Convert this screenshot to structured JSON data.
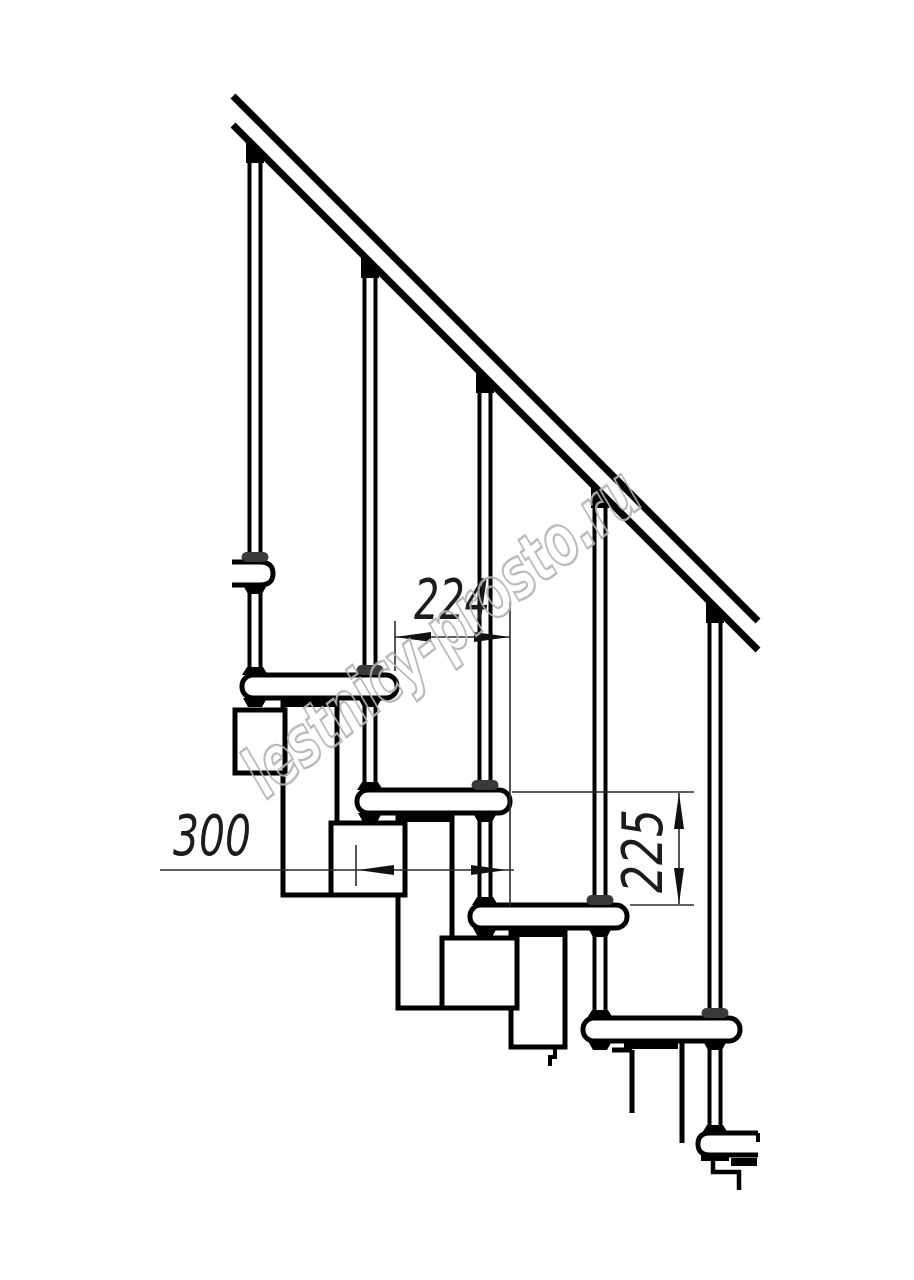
{
  "page": {
    "background": "#ffffff",
    "content_type": "technical line drawing",
    "subject": "modular staircase side elevation with handrail"
  },
  "drawing": {
    "line_color": "#000000",
    "dimension_color": "#2b2b2b",
    "dimensions": [
      {
        "id": "step-run",
        "label": "224",
        "orientation": "horizontal"
      },
      {
        "id": "tread-depth",
        "label": "300",
        "orientation": "horizontal"
      },
      {
        "id": "step-rise",
        "label": "225",
        "orientation": "vertical"
      }
    ],
    "watermark": {
      "text": "lestnicy-prosto.ru",
      "color": "#b3b3b3"
    }
  }
}
